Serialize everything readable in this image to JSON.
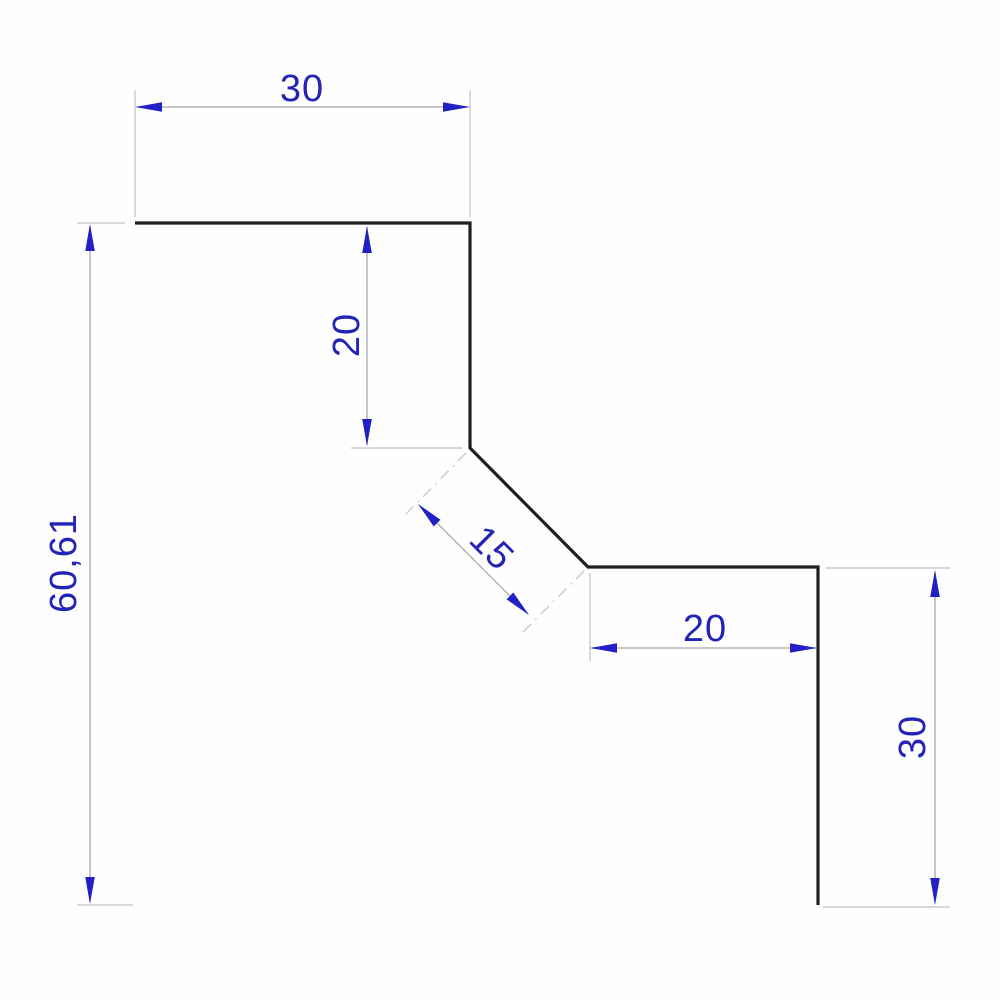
{
  "drawing": {
    "type": "technical-dimension-drawing",
    "background_color": "#fefefe",
    "colors": {
      "profile_outline": "#1f1f1f",
      "dimension_text": "#2323b5",
      "arrowhead": "#2222c4",
      "dimension_line": "#a8a8a8",
      "extension_line": "#c2c2c2"
    },
    "profile": {
      "description": "Stepped sheet profile: top flange, vertical drop, 45-degree chamfer, horizontal step, vertical leg",
      "segments": [
        {
          "name": "top-flange",
          "length_label": "30"
        },
        {
          "name": "upper-vertical",
          "length_label": "20"
        },
        {
          "name": "chamfer-45deg",
          "length_label": "15"
        },
        {
          "name": "lower-horizontal",
          "length_label": "20"
        },
        {
          "name": "right-vertical",
          "length_label": "30"
        }
      ]
    },
    "dimensions": {
      "top_width": {
        "label": "30",
        "value": 30,
        "orientation": "horizontal"
      },
      "upper_height": {
        "label": "20",
        "value": 20,
        "orientation": "vertical"
      },
      "overall_height": {
        "label": "60,61",
        "value": 60.61,
        "orientation": "vertical"
      },
      "diagonal": {
        "label": "15",
        "value": 15,
        "orientation": "diagonal-45"
      },
      "lower_width": {
        "label": "20",
        "value": 20,
        "orientation": "horizontal"
      },
      "right_height": {
        "label": "30",
        "value": 30,
        "orientation": "vertical"
      }
    }
  }
}
